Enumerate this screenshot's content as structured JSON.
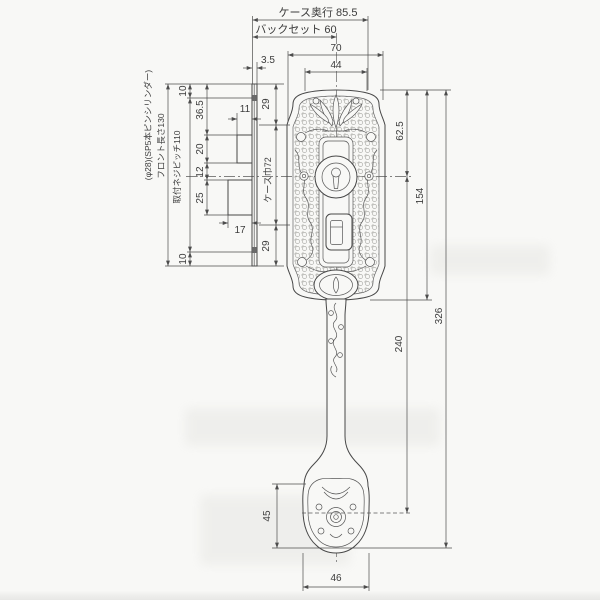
{
  "colors": {
    "paper": "#f8f8f6",
    "line": "#474747",
    "dim_text": "#3c3c3c"
  },
  "top_dims": {
    "case_depth": "ケース奥行 85.5",
    "backset": "バックセット 60",
    "plate_width": "70",
    "top_arc_width": "44",
    "faceplate_thickness": "3.5"
  },
  "left_notes": {
    "cylinder_note": "(φ28)(SP5本ピンシリンダー)",
    "faceplate_length": "フロント長さ130",
    "screw_pitch": "取付ネジピッチ110"
  },
  "left_dims": {
    "top_margin": "10",
    "latch_offset": "36.5",
    "latch_height": "20",
    "gap": "12",
    "deadbolt_height": "25",
    "bottom_margin": "10",
    "latch_projection": "11",
    "deadbolt_projection": "17"
  },
  "case_dims": {
    "top": "29",
    "case_width": "ケース巾72",
    "bottom": "29"
  },
  "right_dims": {
    "cylinder_center": "62.5",
    "plate_length": "154",
    "handle_pitch": "240",
    "overall_length": "326"
  },
  "bottom_dims": {
    "pad_height": "45",
    "pad_width": "46"
  }
}
